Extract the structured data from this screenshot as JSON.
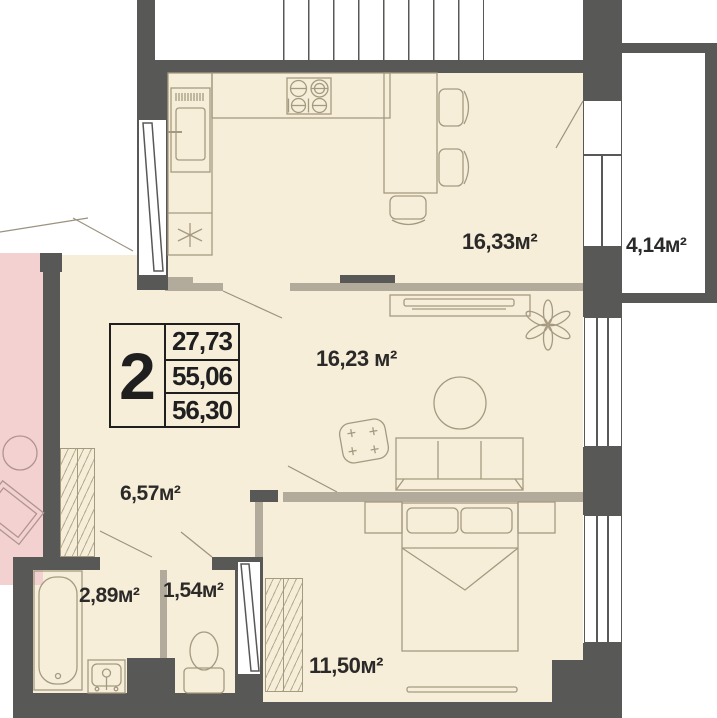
{
  "plan": {
    "title": "2-room apartment floor plan",
    "info_box": {
      "rooms_count": "2",
      "living_area": "27,73",
      "apartment_area": "55,06",
      "total_area": "56,30"
    },
    "rooms": {
      "kitchen_dining": {
        "label": "16,33м²"
      },
      "balcony": {
        "label": "4,14м²"
      },
      "living": {
        "label": "16,23 м²"
      },
      "hallway": {
        "label": "6,57м²"
      },
      "bathroom": {
        "label": "2,89м²"
      },
      "toilet": {
        "label": "1,54м²"
      },
      "bedroom": {
        "label": "11,50м²"
      }
    },
    "colors": {
      "wall": "#585856",
      "floor": "#f6eed9",
      "partition": "#b2ab9c",
      "adjacent_room": "#f2d1d0",
      "furniture_line": "#a59a80",
      "text": "#2b2a28"
    }
  }
}
